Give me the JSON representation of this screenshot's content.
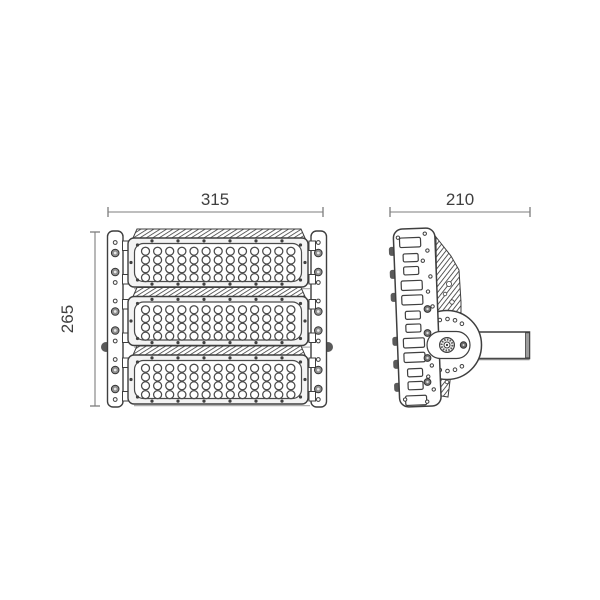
{
  "drawing": {
    "kind": "technical-dimension-drawing",
    "subject": "modular-led-floodlight",
    "front_width_label": "315",
    "front_height_label": "265",
    "side_depth_label": "210",
    "colors": {
      "line": "#3f3f3f",
      "line_soft": "#4a4a4a",
      "dim_line": "#7d7d7d",
      "text": "#3f3f3f",
      "fill_light": "#f3f3f3",
      "screw_fill": "#8f8f8f",
      "shadow": "#adadad",
      "background": "#ffffff"
    },
    "front_view": {
      "modules": 3,
      "led_rows": 4,
      "led_columns": 13,
      "frame_screws_per_edge": 6
    },
    "side_view": {
      "slot_groups": 3,
      "slots_per_group": 4,
      "arc_holes_per_arc": 4,
      "plate_screws": 4,
      "edge_bumps": 6
    }
  }
}
